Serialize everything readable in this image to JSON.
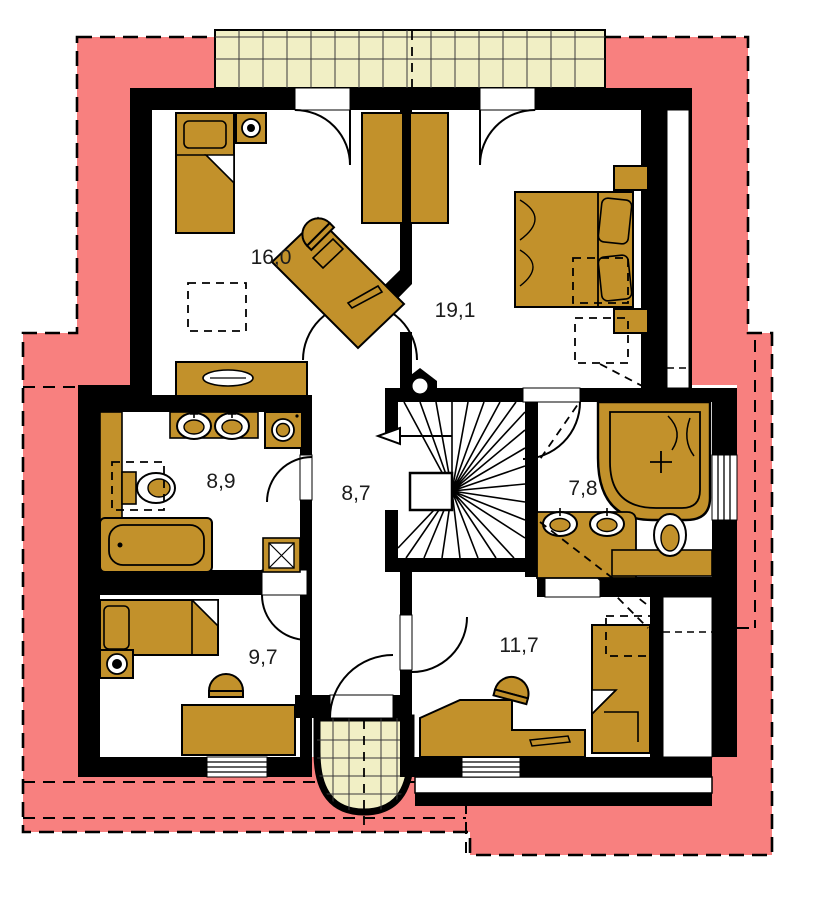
{
  "plan": {
    "type": "floor-plan-upper-storey",
    "rooms": [
      {
        "id": "bedroom-upper-left",
        "area": "16,0"
      },
      {
        "id": "bedroom-upper-right",
        "area": "19,1"
      },
      {
        "id": "bathroom-left",
        "area": "8,9"
      },
      {
        "id": "hallway-center",
        "area": "8,7"
      },
      {
        "id": "bathroom-right",
        "area": "7,8"
      },
      {
        "id": "bedroom-lower-left",
        "area": "9,7"
      },
      {
        "id": "bedroom-lower-right",
        "area": "11,7"
      }
    ],
    "colors": {
      "roof_overhang": "#F8807F",
      "balcony_tiles": "#F1EFC5",
      "furniture": "#C2912B",
      "walls": "#000000",
      "floor": "#FFFFFF"
    }
  }
}
